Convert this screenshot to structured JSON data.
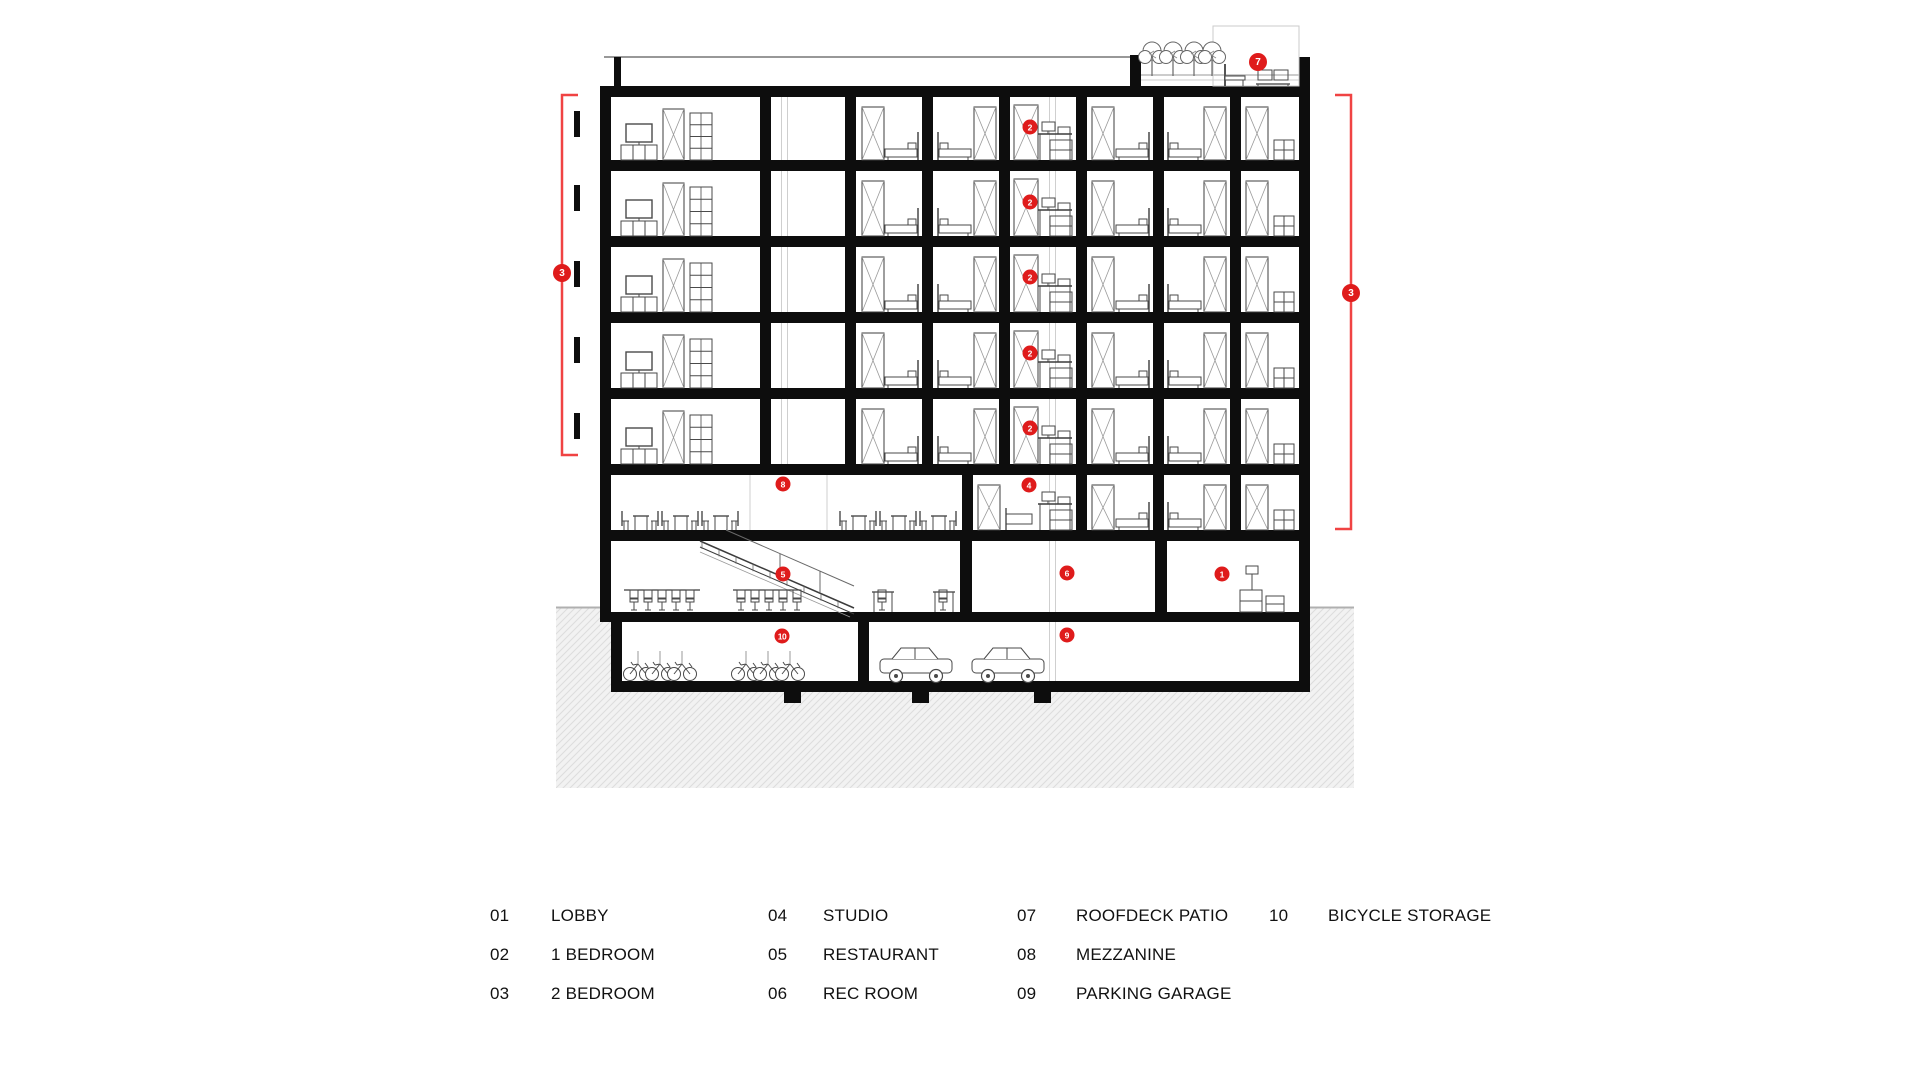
{
  "colors": {
    "dot_red": "#df1b1b",
    "bracket_red": "#f04343",
    "ink": "#0d0d0d",
    "furniture_line": "#4a4a4a",
    "light_line": "#cfcfcf",
    "earth_fill": "#f2f2f2",
    "hatch_line": "#dddddd",
    "text": "#111111"
  },
  "keynotes": [
    {
      "number": "7",
      "x": 1258,
      "y": 62,
      "size": 18
    },
    {
      "number": "3",
      "x": 562,
      "y": 273,
      "size": 18
    },
    {
      "number": "3",
      "x": 1351,
      "y": 293,
      "size": 18
    },
    {
      "number": "2",
      "x": 1030,
      "y": 127,
      "size": 15
    },
    {
      "number": "2",
      "x": 1030,
      "y": 202,
      "size": 15
    },
    {
      "number": "2",
      "x": 1030,
      "y": 277,
      "size": 15
    },
    {
      "number": "2",
      "x": 1030,
      "y": 353,
      "size": 15
    },
    {
      "number": "2",
      "x": 1030,
      "y": 428,
      "size": 15
    },
    {
      "number": "4",
      "x": 1029,
      "y": 485,
      "size": 15
    },
    {
      "number": "8",
      "x": 783,
      "y": 484,
      "size": 15
    },
    {
      "number": "5",
      "x": 783,
      "y": 574,
      "size": 15
    },
    {
      "number": "6",
      "x": 1067,
      "y": 573,
      "size": 15
    },
    {
      "number": "1",
      "x": 1222,
      "y": 574,
      "size": 15
    },
    {
      "number": "10",
      "x": 782,
      "y": 636,
      "size": 15
    },
    {
      "number": "9",
      "x": 1067,
      "y": 635,
      "size": 15
    }
  ],
  "brackets": [
    {
      "side": "left",
      "x": 562,
      "y1": 95,
      "y2": 455,
      "tick": 16
    },
    {
      "side": "right",
      "x": 1351,
      "y1": 95,
      "y2": 529,
      "tick": -16
    }
  ],
  "legend": {
    "rows_top": [
      906,
      945,
      984
    ],
    "columns": [
      {
        "num_x": 490,
        "label_x": 551,
        "items": [
          {
            "num": "01",
            "label": "LOBBY"
          },
          {
            "num": "02",
            "label": "1 BEDROOM"
          },
          {
            "num": "03",
            "label": "2 BEDROOM"
          }
        ]
      },
      {
        "num_x": 768,
        "label_x": 823,
        "items": [
          {
            "num": "04",
            "label": "STUDIO"
          },
          {
            "num": "05",
            "label": "RESTAURANT"
          },
          {
            "num": "06",
            "label": "REC ROOM"
          }
        ]
      },
      {
        "num_x": 1017,
        "label_x": 1076,
        "items": [
          {
            "num": "07",
            "label": "ROOFDECK PATIO"
          },
          {
            "num": "08",
            "label": "MEZZANINE"
          },
          {
            "num": "09",
            "label": "PARKING GARAGE"
          }
        ]
      },
      {
        "num_x": 1269,
        "label_x": 1328,
        "items": [
          {
            "num": "10",
            "label": "BICYCLE STORAGE"
          }
        ]
      }
    ]
  }
}
